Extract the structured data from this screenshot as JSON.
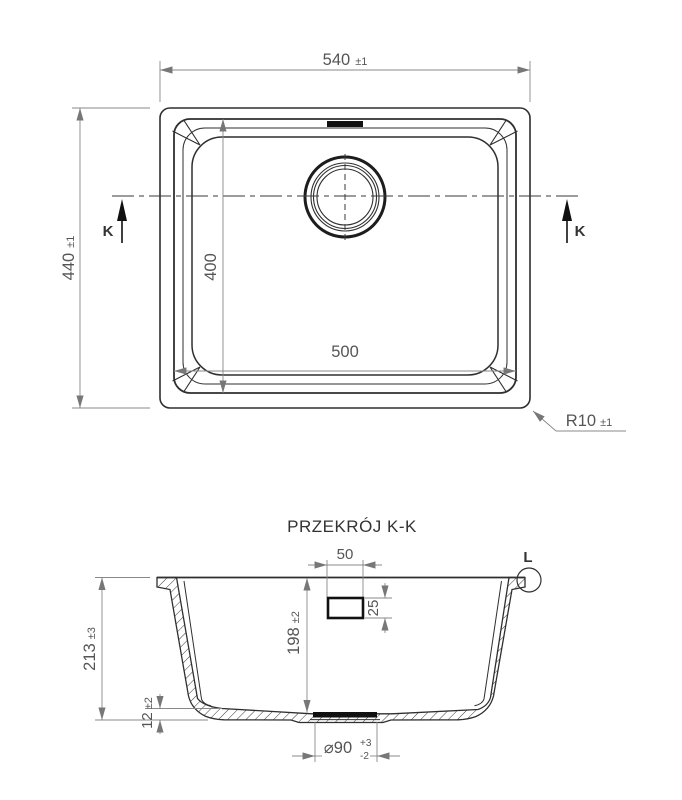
{
  "top_view": {
    "width_dim": "540",
    "width_tol": "±1",
    "height_dim": "440",
    "height_tol": "±1",
    "inner_width_dim": "500",
    "inner_height_dim": "400",
    "radius_dim": "R10",
    "radius_tol": "±1",
    "section_marker": "K"
  },
  "section_view": {
    "title": "PRZEKRÓJ K-K",
    "detail_marker": "L",
    "overflow_width": "50",
    "overflow_height": "25",
    "depth_dim": "198",
    "depth_tol": "±2",
    "height_dim": "213",
    "height_tol": "±3",
    "base_dim": "12",
    "base_tol": "±2",
    "drain_dim": "⌀90",
    "drain_tol_plus": "+3",
    "drain_tol_minus": "-2"
  },
  "colors": {
    "outline": "#2f2f2f",
    "dimension": "#7a7a7a",
    "text": "#555555",
    "fill_dark": "#111111",
    "background": "#ffffff"
  }
}
